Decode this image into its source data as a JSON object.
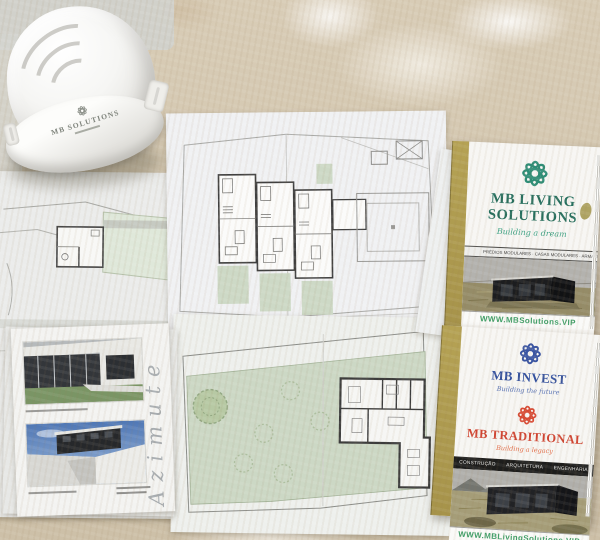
{
  "surface": {
    "base_color": "#d6cab6",
    "paint_color": "#f4f0e8"
  },
  "helmet": {
    "brand": "MB SOLUTIONS"
  },
  "left_documents": {
    "handwritten_note": "Azimute"
  },
  "brochure_living": {
    "brand_line1": "MB LIVING",
    "brand_line2": "SOLUTIONS",
    "tagline": "Building a dream",
    "services_band": "PRÉDIOS MODULARES · CASAS MODULARES · ARMAZÉNS MODULARES",
    "website": "WWW.MBSolutions.VIP",
    "accent_color": "#2e8d76",
    "gold_color": "#b1a054"
  },
  "brochure_invest": {
    "brand_top": "MB INVEST",
    "tagline_top": "Building the future",
    "brand_bottom": "MB TRADITIONAL",
    "tagline_bottom": "Building a legacy",
    "band_items": [
      "CONSTRUÇÃO",
      "ARQUITETURA",
      "ENGENHARIA"
    ],
    "website": "WWW.MBLivingSolutions.VIP",
    "blue_color": "#3a55a3",
    "red_color": "#d84b35"
  }
}
